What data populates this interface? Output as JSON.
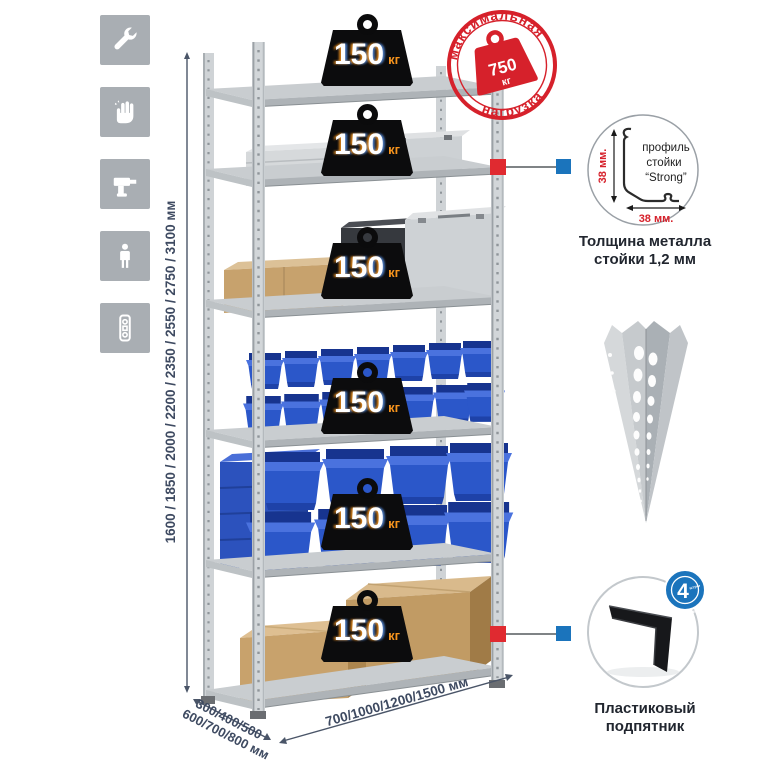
{
  "sidebar": {
    "icons": [
      "wrench",
      "gloves",
      "drill",
      "person",
      "perforated-profile"
    ]
  },
  "rack": {
    "weights": [
      {
        "value": "150",
        "unit": "кг"
      },
      {
        "value": "150",
        "unit": "кг"
      },
      {
        "value": "150",
        "unit": "кг"
      },
      {
        "value": "150",
        "unit": "кг"
      },
      {
        "value": "150",
        "unit": "кг"
      },
      {
        "value": "150",
        "unit": "кг"
      }
    ],
    "stamp": {
      "arc_top": "максимальная",
      "arc_bottom": "нагрузка",
      "value": "750",
      "unit": "кг"
    }
  },
  "dimensions": {
    "height": "1600 / 1850 / 2000 / 2200 / 2350 / 2550 / 2750 / 3100 мм",
    "depth_line1": "300/400/500",
    "depth_line2": "600/700/800 мм",
    "width": "700/1000/1200/1500 мм"
  },
  "details": {
    "profile": {
      "line1": "профиль",
      "line2": "стойки",
      "line3": "“Strong”",
      "dim_vertical": "38 мм.",
      "dim_horizontal": "38 мм.",
      "caption1": "Толщина металла",
      "caption2": "стойки 1,2 мм"
    },
    "foot": {
      "badge_value": "4",
      "badge_pieces": "штуки",
      "badge_arc": "в комплекте",
      "caption1": "Пластиковый",
      "caption2": "подпятник"
    }
  },
  "colors": {
    "stamp_red": "#d6212b",
    "marker_red": "#e02a30",
    "marker_blue": "#1b74bc",
    "bin_blue": "#2b57c9",
    "dimension_text": "#3e4a61",
    "icon_tile_gray": "#a9aeb3"
  }
}
